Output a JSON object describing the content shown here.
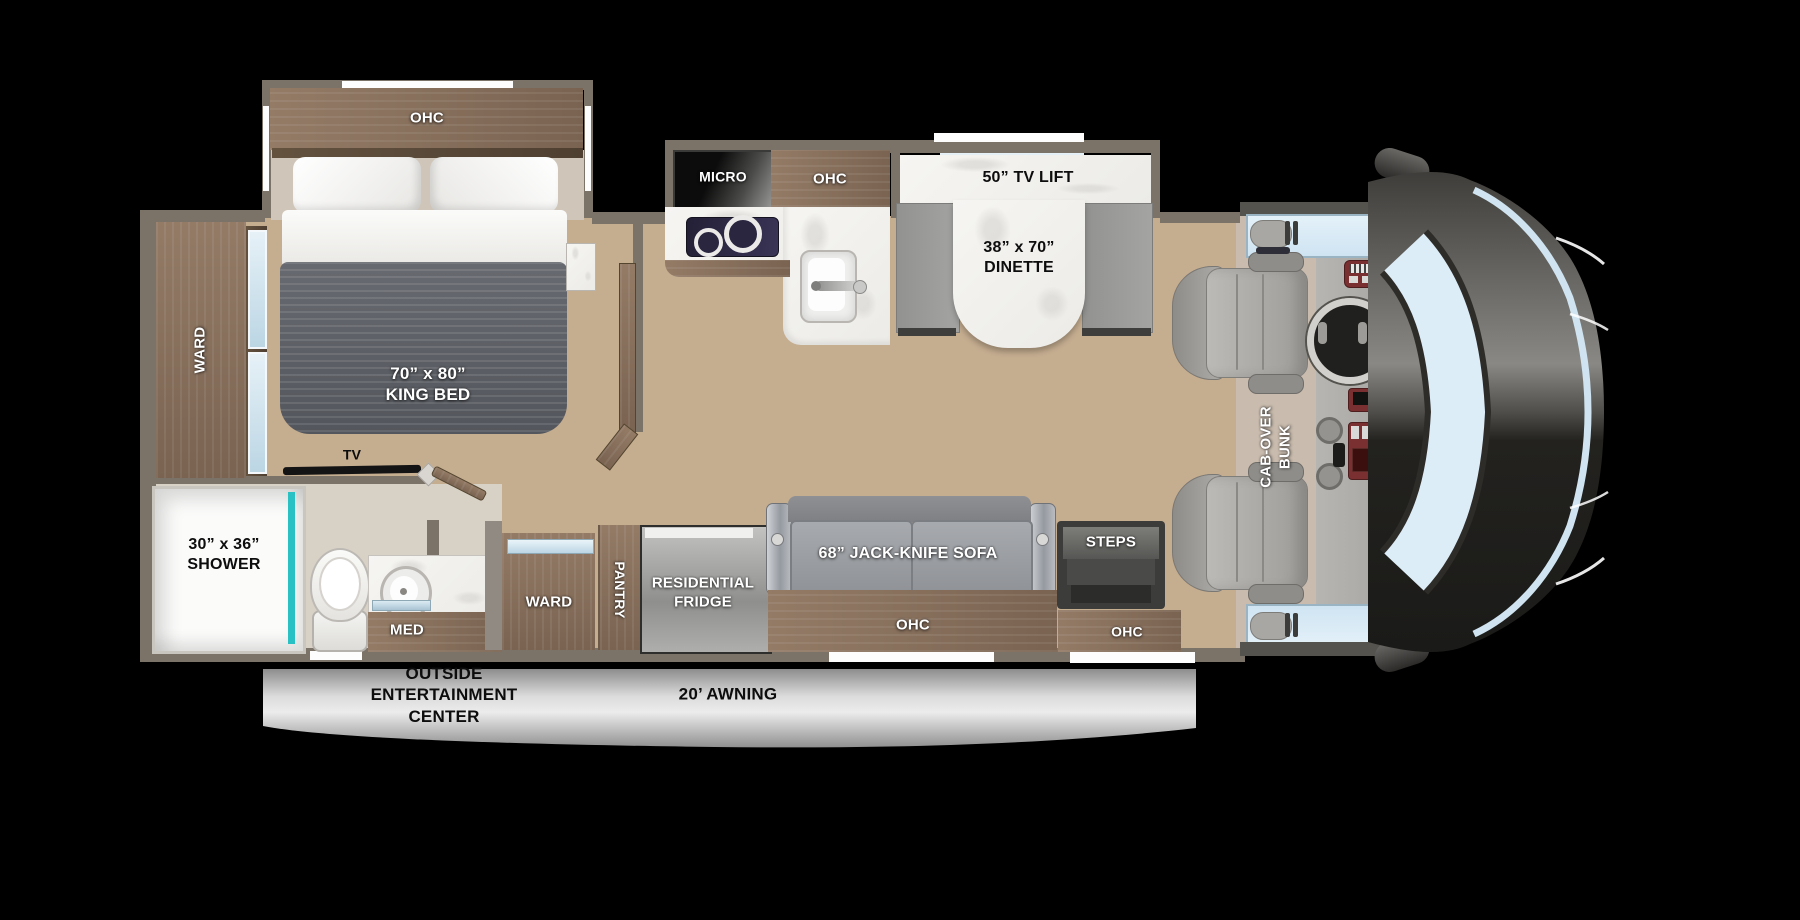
{
  "title": "Class C motorhome floor plan",
  "labels": {
    "bedroom_ohc": "OHC",
    "king_bed_l1": "70” x 80”",
    "king_bed_l2": "KING BED",
    "ward_left": "WARD",
    "tv": "TV",
    "shower_l1": "30” x 36”",
    "shower_l2": "SHOWER",
    "med": "MED",
    "micro": "MICRO",
    "kitchen_ohc": "OHC",
    "tv_lift": "50” TV LIFT",
    "dinette_l1": "38” x 70”",
    "dinette_l2": "DINETTE",
    "ward_bottom": "WARD",
    "pantry": "PANTRY",
    "fridge_l1": "RESIDENTIAL",
    "fridge_l2": "FRIDGE",
    "sofa": "68” JACK-KNIFE SOFA",
    "sofa_ohc": "OHC",
    "steps": "STEPS",
    "entry_ohc": "OHC",
    "cab_over_l1": "CAB-OVER",
    "cab_over_l2": "BUNK",
    "outside_l1": "OUTSIDE",
    "outside_l2": "ENTERTAINMENT",
    "outside_l3": "CENTER",
    "awning": "20’ AWNING"
  },
  "colors": {
    "background": "#000000",
    "wall_gray": "#7b7268",
    "cabinet_wood": "#8a7360",
    "floor_wood": "#c5ad90",
    "counter_marble": "#f4f3f0",
    "shower_teal": "#2ac1c4",
    "window_glass_blue": "#d9ecf8",
    "bench_gray": "#9d9d9b",
    "bed_blanket_gray": "#5d6066",
    "awning_band_gray": "#d9d9d9",
    "cab_floor_beige": "#c9bcae",
    "front_cap_dark": "#232220"
  }
}
